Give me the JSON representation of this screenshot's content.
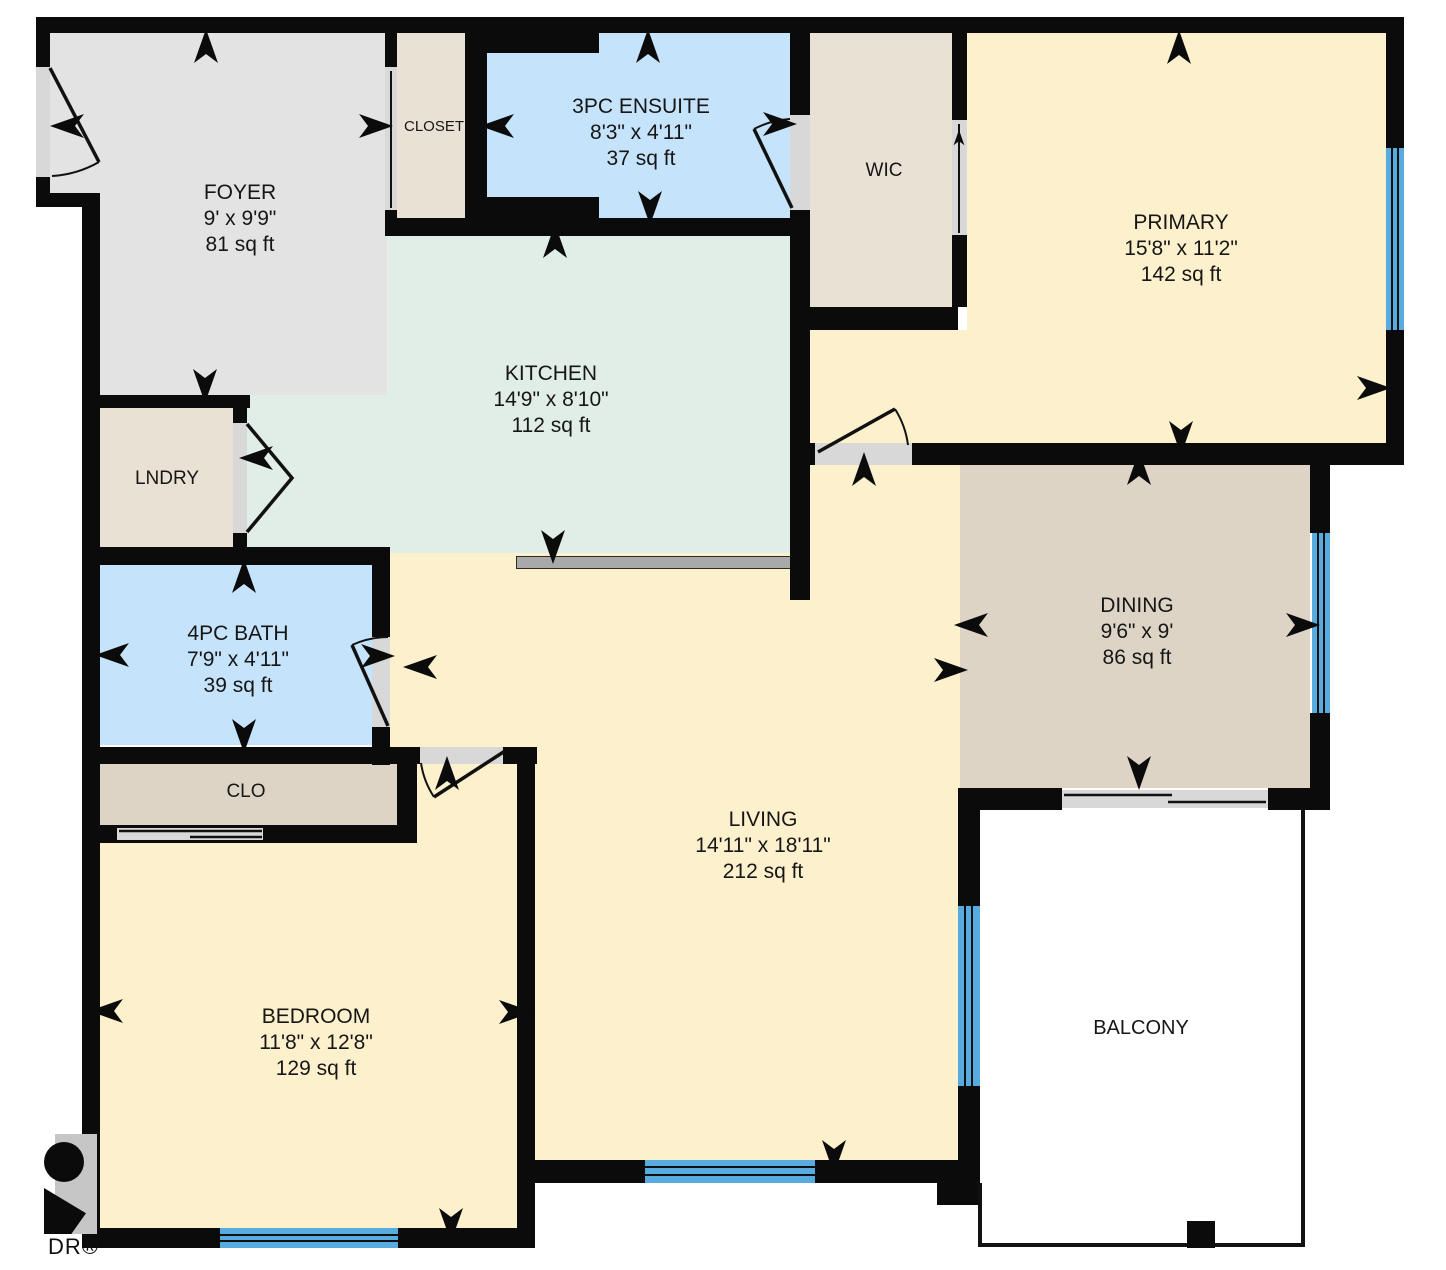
{
  "rooms": {
    "foyer": {
      "name": "FOYER",
      "dims": "9' x 9'9\"",
      "area": "81 sq ft"
    },
    "closet": {
      "name": "CLOSET"
    },
    "ensuite": {
      "name": "3PC ENSUITE",
      "dims": "8'3\" x 4'11\"",
      "area": "37 sq ft"
    },
    "wic": {
      "name": "WIC"
    },
    "primary": {
      "name": "PRIMARY",
      "dims": "15'8\" x 11'2\"",
      "area": "142 sq ft"
    },
    "kitchen": {
      "name": "KITCHEN",
      "dims": "14'9\" x 8'10\"",
      "area": "112 sq ft"
    },
    "laundry": {
      "name": "LNDRY"
    },
    "dining": {
      "name": "DINING",
      "dims": "9'6\" x 9'",
      "area": "86 sq ft"
    },
    "bath": {
      "name": "4PC BATH",
      "dims": "7'9\" x 4'11\"",
      "area": "39 sq ft"
    },
    "clo": {
      "name": "CLO"
    },
    "living": {
      "name": "LIVING",
      "dims": "14'11\" x 18'11\"",
      "area": "212 sq ft"
    },
    "bedroom": {
      "name": "BEDROOM",
      "dims": "11'8\" x 12'8\"",
      "area": "129 sq ft"
    },
    "balcony": {
      "name": "BALCONY"
    }
  },
  "watermark": "DR®",
  "colors": {
    "wall": "#0b0b0b",
    "window_blue": "#57abdf",
    "room_cream": "#fdf0cc",
    "bath_blue": "#c5e3fb",
    "kitchen_green": "#e1eee7",
    "foyer_gray": "#e3e3e3",
    "closet_beige": "#e9e1d4",
    "dining_tan": "#ddd4c6",
    "door_opening": "#d8d8d8",
    "counter_gray": "#a9a9a9"
  }
}
